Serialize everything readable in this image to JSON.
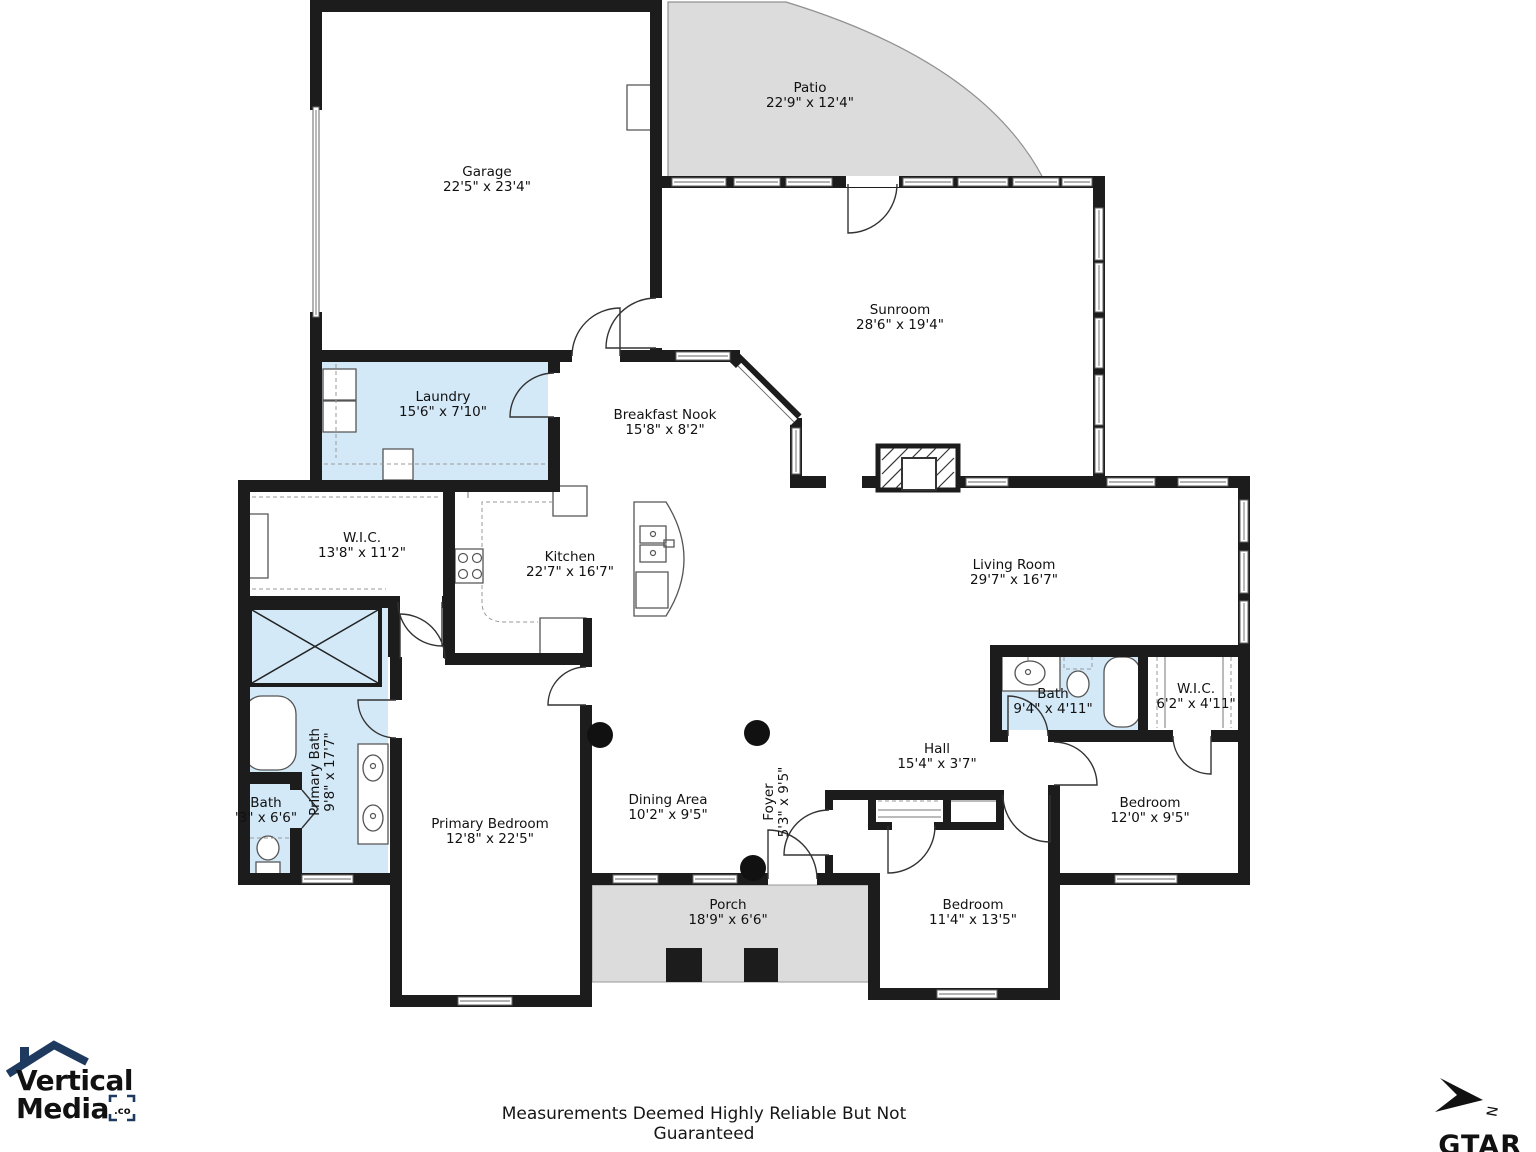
{
  "plan": {
    "rooms": [
      {
        "id": "garage",
        "name": "Garage",
        "dims": "22'5\" x 23'4\""
      },
      {
        "id": "patio",
        "name": "Patio",
        "dims": "22'9\" x 12'4\""
      },
      {
        "id": "sunroom",
        "name": "Sunroom",
        "dims": "28'6\" x 19'4\""
      },
      {
        "id": "laundry",
        "name": "Laundry",
        "dims": "15'6\" x 7'10\""
      },
      {
        "id": "breakfast-nook",
        "name": "Breakfast Nook",
        "dims": "15'8\" x 8'2\""
      },
      {
        "id": "wic-primary",
        "name": "W.I.C.",
        "dims": "13'8\" x 11'2\""
      },
      {
        "id": "kitchen",
        "name": "Kitchen",
        "dims": "22'7\" x 16'7\""
      },
      {
        "id": "living-room",
        "name": "Living Room",
        "dims": "29'7\" x 16'7\""
      },
      {
        "id": "bath-hall",
        "name": "Bath",
        "dims": "9'4\" x 4'11\""
      },
      {
        "id": "wic-hall",
        "name": "W.I.C.",
        "dims": "6'2\" x 4'11\""
      },
      {
        "id": "primary-bath",
        "name": "Primary Bath",
        "dims": "9'8\" x 17'7\""
      },
      {
        "id": "bath-small",
        "name": "Bath",
        "dims": "'3\" x 6'6\""
      },
      {
        "id": "primary-bedroom",
        "name": "Primary Bedroom",
        "dims": "12'8\" x 22'5\""
      },
      {
        "id": "dining-area",
        "name": "Dining Area",
        "dims": "10'2\" x 9'5\""
      },
      {
        "id": "foyer",
        "name": "Foyer",
        "dims": "5'3\" x 9'5\""
      },
      {
        "id": "hall",
        "name": "Hall",
        "dims": "15'4\" x 3'7\""
      },
      {
        "id": "bedroom-right",
        "name": "Bedroom",
        "dims": "12'0\" x 9'5\""
      },
      {
        "id": "bedroom-bottom",
        "name": "Bedroom",
        "dims": "11'4\" x 13'5\""
      },
      {
        "id": "porch",
        "name": "Porch",
        "dims": "18'9\" x 6'6\""
      }
    ],
    "colors": {
      "wet_room_fill": "#d3e9f8",
      "outdoor_fill": "#dcdcdc",
      "wall": "#1c1c1c"
    }
  },
  "footer": {
    "disclaimer": "Measurements Deemed Highly Reliable But Not Guaranteed"
  },
  "branding": {
    "logo_line1": "Vertical",
    "logo_line2": "Media",
    "logo_suffix": ".co",
    "attribution": "GTAR"
  },
  "compass": {
    "north_label": "N"
  }
}
